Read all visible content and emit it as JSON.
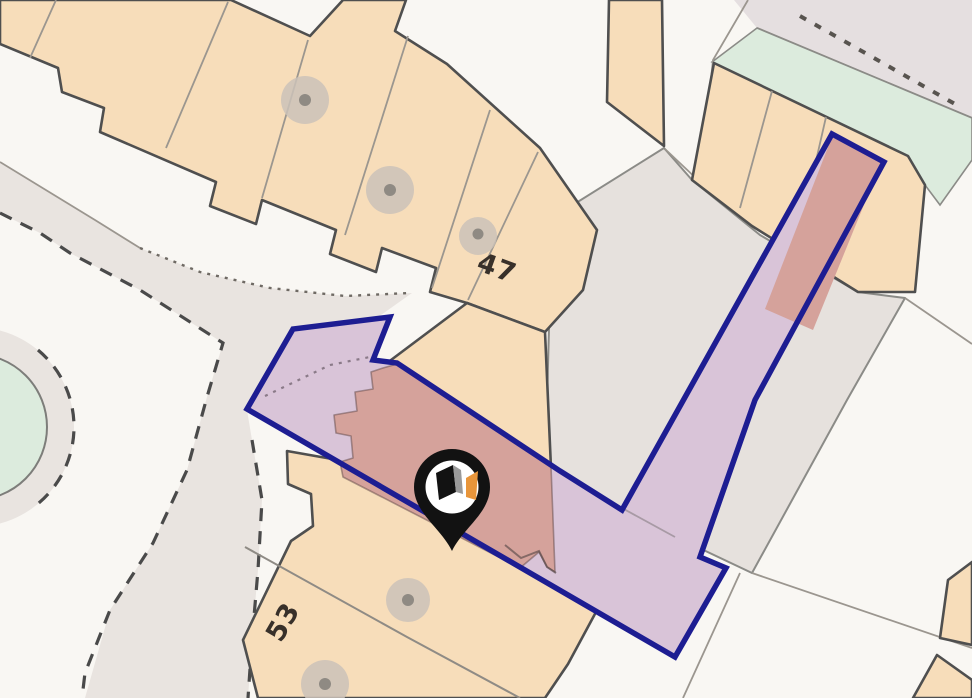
{
  "map": {
    "type": "property-location-map",
    "plot_labels": [
      {
        "text": "47",
        "kind": "house-number"
      },
      {
        "text": "53",
        "kind": "house-number"
      }
    ],
    "marker": {
      "icon": "property-pin-icon",
      "description": "black map pin with white disc containing black cube and orange flag logo"
    },
    "boundary_plot": {
      "style": "navy outline with translucent purple fill; buildings inside shown salmon",
      "shape": "L-shaped plot with arrow notch at west end and long strip running north-east"
    },
    "features": {
      "trees": 5,
      "green_spaces": 2,
      "roads": 2
    }
  },
  "colors": {
    "base-white": "#f9f7f3",
    "road-gray": "#e9e4e0",
    "road-gray-tr": "#e5dfe0",
    "parcel-gray": "#e6e1dd",
    "building-peach": "#f7ddba",
    "building-outline": "#4f4f4f",
    "parcel-line": "#9b968f",
    "green-space": "#dcebdd",
    "tree-fill": "#cbc2b9",
    "tree-dot": "#8f8a83",
    "dash-color": "#4a4a4a",
    "boundary-navy": "#1d1d92",
    "plot-lilac": "#d9c4d8",
    "plot-salmon": "#d5a29b",
    "pin-black": "#121212",
    "logo-orange": "#e8953a",
    "logo-gray": "#9a9a9a"
  }
}
